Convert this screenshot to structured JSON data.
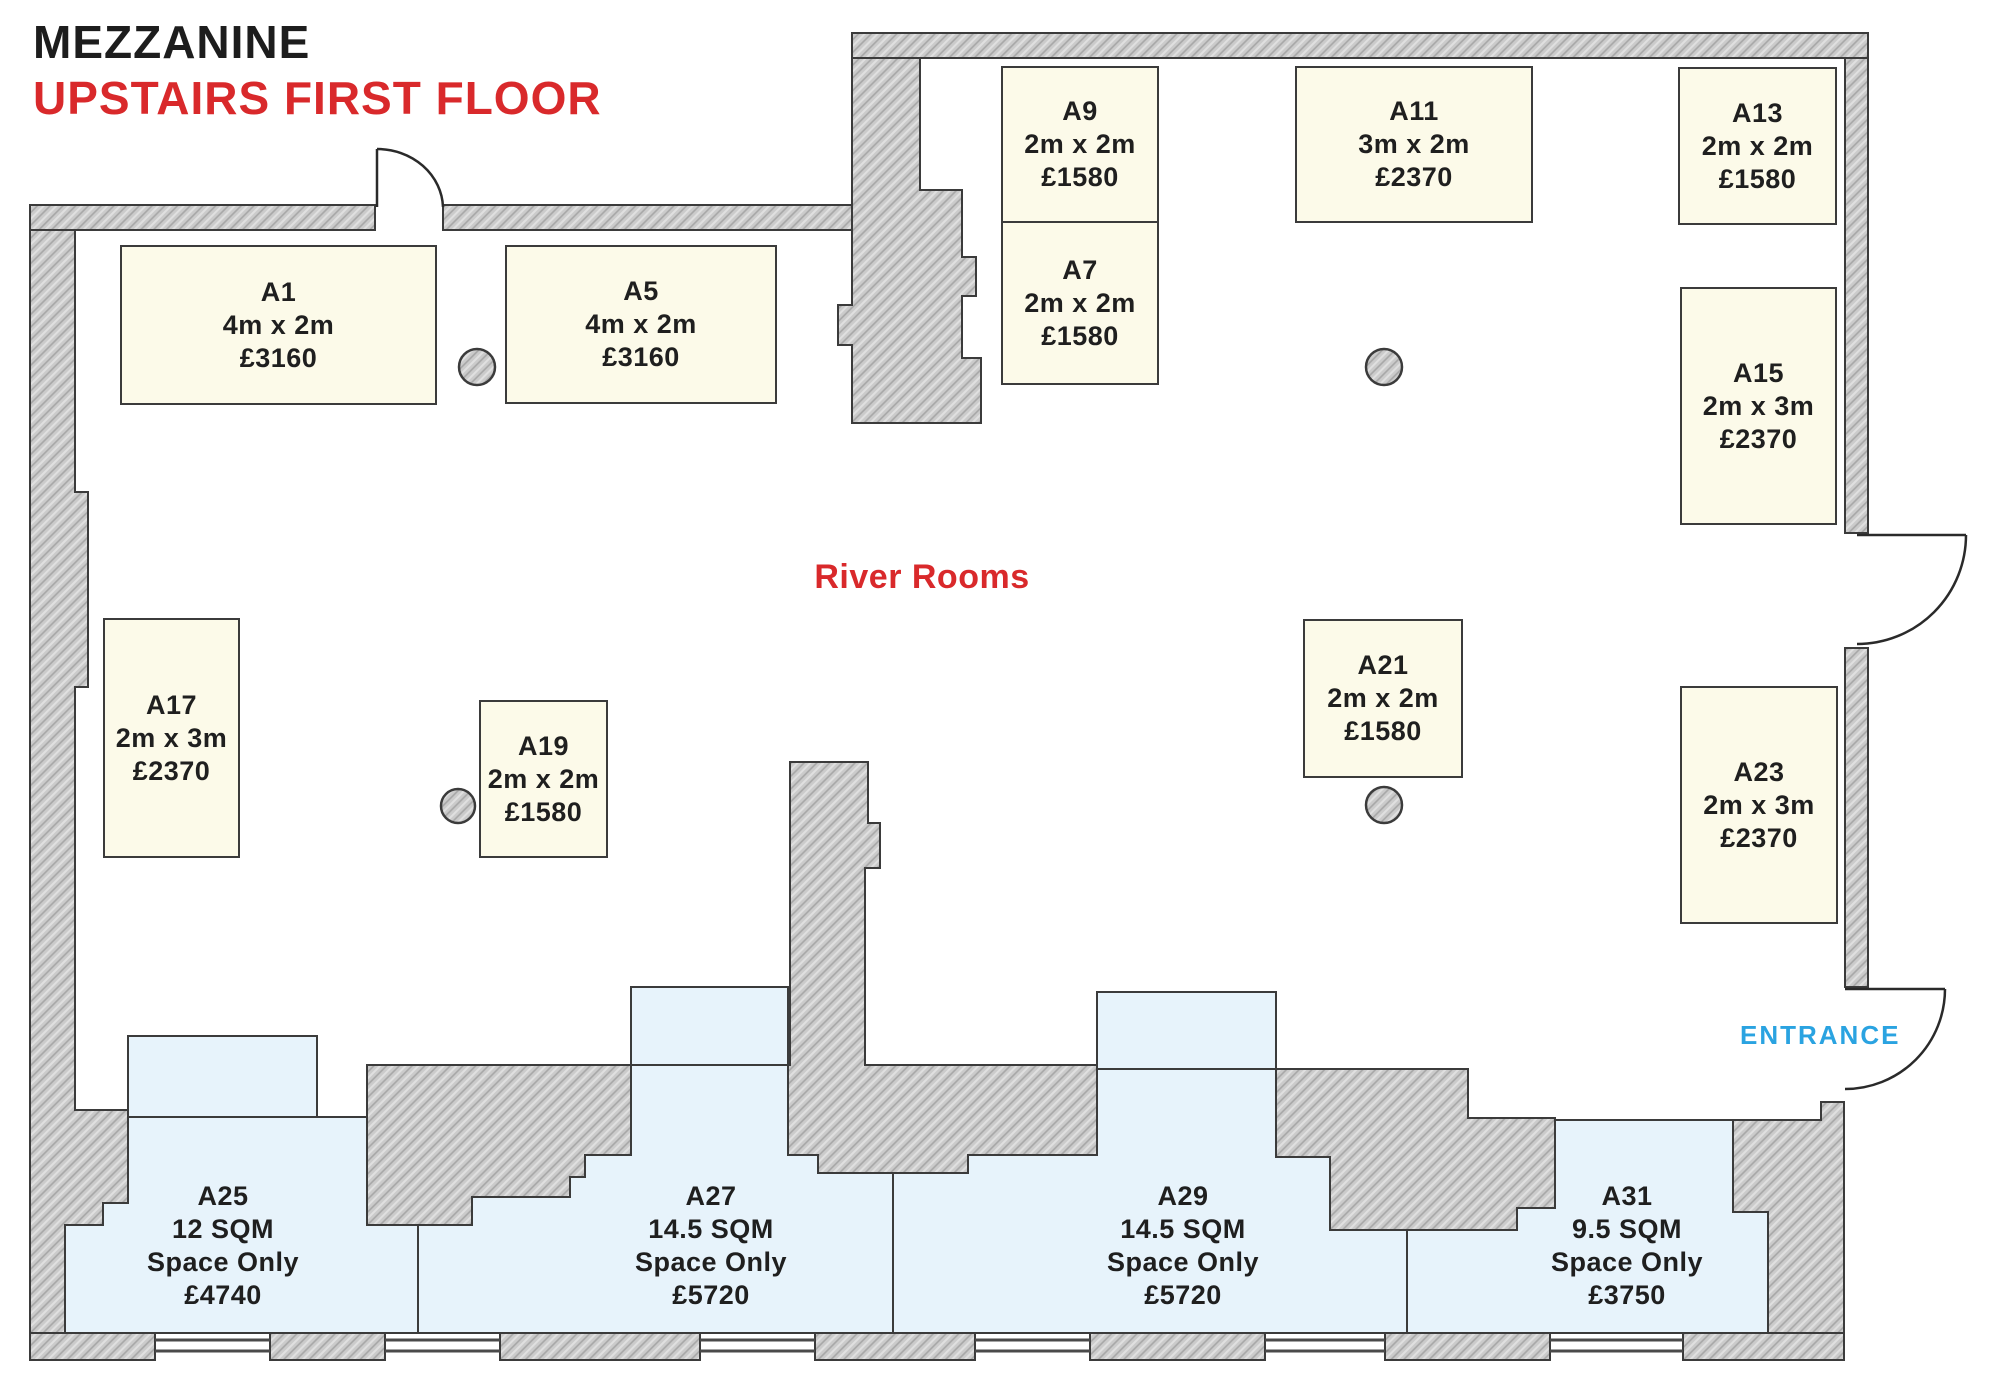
{
  "title": {
    "line1": "MEZZANINE",
    "line2": "UPSTAIRS FIRST FLOOR"
  },
  "area_label": "River Rooms",
  "entrance_label": "ENTRANCE",
  "colors": {
    "accent_red": "#d9292b",
    "entrance_blue": "#2aa3e1",
    "shell_stand_fill": "#fcfae9",
    "space_only_fill": "#e7f3fb",
    "wall_fill": "#cbcbcb",
    "outline": "#3b3b3b"
  },
  "stands": {
    "shell_scheme": [
      {
        "id": "A1",
        "size": "4m x 2m",
        "price": "£3160"
      },
      {
        "id": "A5",
        "size": "4m x 2m",
        "price": "£3160"
      },
      {
        "id": "A7",
        "size": "2m x 2m",
        "price": "£1580"
      },
      {
        "id": "A9",
        "size": "2m x 2m",
        "price": "£1580"
      },
      {
        "id": "A11",
        "size": "3m x 2m",
        "price": "£2370"
      },
      {
        "id": "A13",
        "size": "2m x 2m",
        "price": "£1580"
      },
      {
        "id": "A15",
        "size": "2m x 3m",
        "price": "£2370"
      },
      {
        "id": "A17",
        "size": "2m x 3m",
        "price": "£2370"
      },
      {
        "id": "A19",
        "size": "2m x 2m",
        "price": "£1580"
      },
      {
        "id": "A21",
        "size": "2m x 2m",
        "price": "£1580"
      },
      {
        "id": "A23",
        "size": "2m x 3m",
        "price": "£2370"
      }
    ],
    "space_only": [
      {
        "id": "A25",
        "size": "12 SQM",
        "type": "Space Only",
        "price": "£4740"
      },
      {
        "id": "A27",
        "size": "14.5 SQM",
        "type": "Space Only",
        "price": "£5720"
      },
      {
        "id": "A29",
        "size": "14.5 SQM",
        "type": "Space Only",
        "price": "£5720"
      },
      {
        "id": "A31",
        "size": "9.5 SQM",
        "type": "Space Only",
        "price": "£3750"
      }
    ]
  }
}
